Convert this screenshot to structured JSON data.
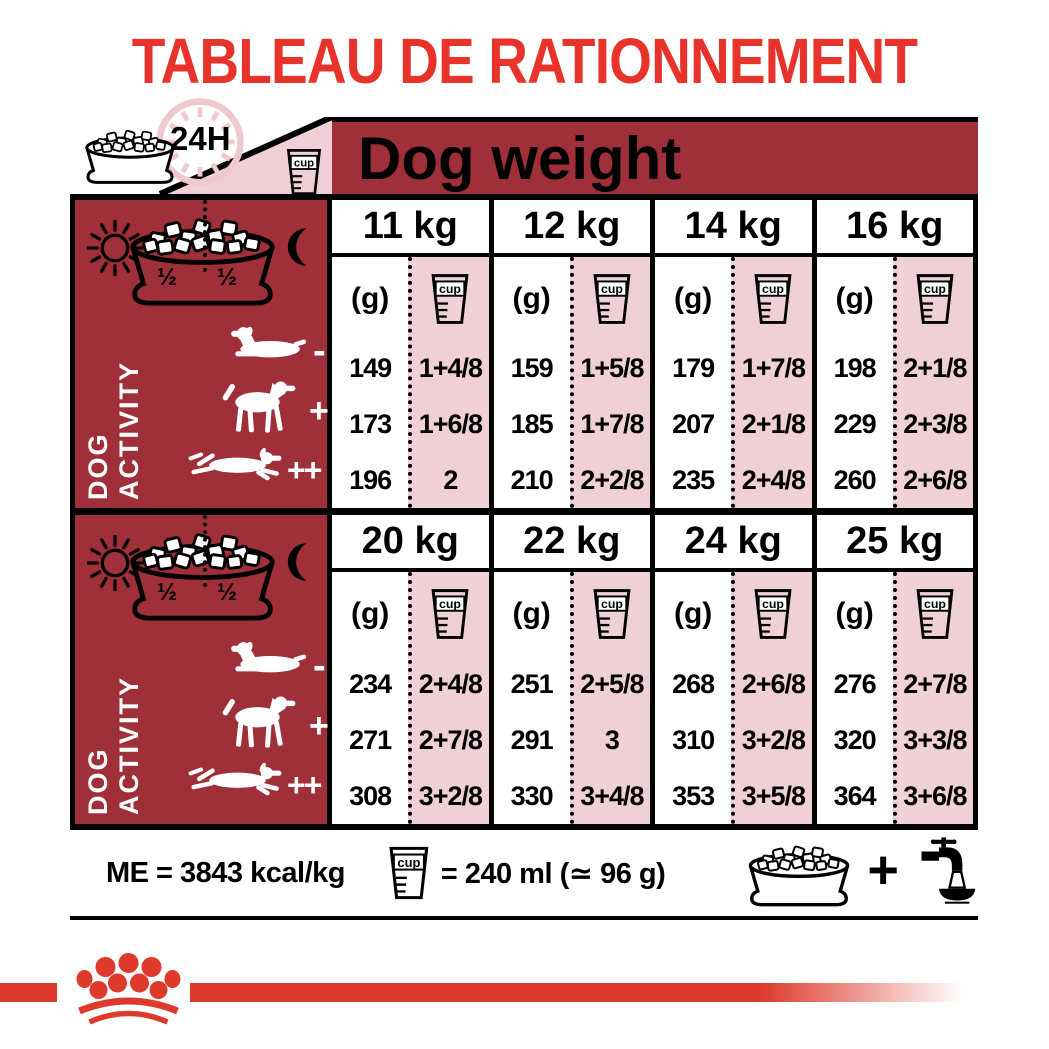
{
  "title": "TABLEAU DE RATIONNEMENT",
  "header": {
    "duration_badge": "24H",
    "dog_weight_label": "Dog weight"
  },
  "units": {
    "grams": "(g)",
    "cup_word": "cup"
  },
  "activity": {
    "label": "DOG ACTIVITY",
    "half_left": "½",
    "half_right": "½",
    "markers": {
      "low": "-",
      "medium": "+",
      "high": "++"
    }
  },
  "sections": [
    {
      "columns": [
        {
          "weight": "11 kg",
          "grams": [
            149,
            173,
            196
          ],
          "cups": [
            "1+4/8",
            "1+6/8",
            "2"
          ]
        },
        {
          "weight": "12 kg",
          "grams": [
            159,
            185,
            210
          ],
          "cups": [
            "1+5/8",
            "1+7/8",
            "2+2/8"
          ]
        },
        {
          "weight": "14 kg",
          "grams": [
            179,
            207,
            235
          ],
          "cups": [
            "1+7/8",
            "2+1/8",
            "2+4/8"
          ]
        },
        {
          "weight": "16 kg",
          "grams": [
            198,
            229,
            260
          ],
          "cups": [
            "2+1/8",
            "2+3/8",
            "2+6/8"
          ]
        }
      ]
    },
    {
      "columns": [
        {
          "weight": "20 kg",
          "grams": [
            234,
            271,
            308
          ],
          "cups": [
            "2+4/8",
            "2+7/8",
            "3+2/8"
          ]
        },
        {
          "weight": "22 kg",
          "grams": [
            251,
            291,
            330
          ],
          "cups": [
            "2+5/8",
            "3",
            "3+4/8"
          ]
        },
        {
          "weight": "24 kg",
          "grams": [
            268,
            310,
            353
          ],
          "cups": [
            "2+6/8",
            "3+2/8",
            "3+5/8"
          ]
        },
        {
          "weight": "25 kg",
          "grams": [
            276,
            320,
            364
          ],
          "cups": [
            "2+7/8",
            "3+3/8",
            "3+6/8"
          ]
        }
      ]
    }
  ],
  "footer": {
    "energy": "ME = 3843 kcal/kg",
    "cup_equivalence": "= 240 ml (≃ 96 g)",
    "plus_sign": "+"
  },
  "colors": {
    "accent_red": "#E8332B",
    "dark_red": "#9F2F38",
    "pink": "#EFD0D6",
    "brand_red": "#DD3A2C",
    "clock_pink": "#F0C8CF"
  }
}
